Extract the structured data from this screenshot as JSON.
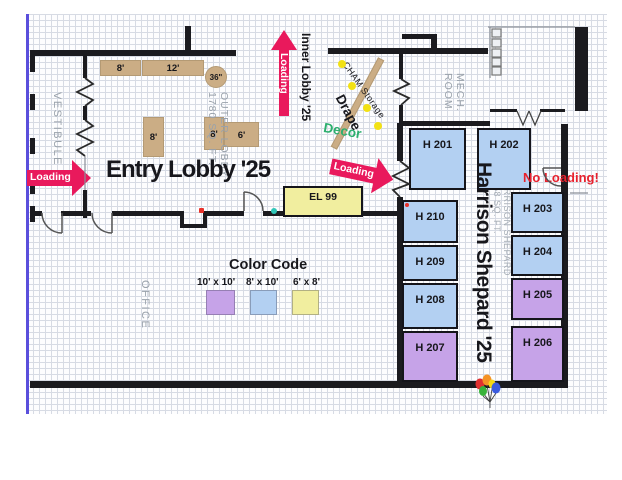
{
  "plan": {
    "entry_lobby_title": "Entry Lobby '25",
    "inner_lobby_title": "Inner Lobby '25",
    "harrison_title": "Harrison Shepard '25",
    "no_loading": "No Loading!",
    "loading": "Loading",
    "rooms": {
      "vestibule": "VESTIBULE",
      "outer_lobby": "OUTER LOBBY\n1780 SQ. FT.",
      "mech_room": "MECH.\nROOM",
      "office": "OFFICE",
      "harrison_corridor": "HARRISON SHEPARD\n1458 SQ. FT."
    },
    "annotations": {
      "cham_storage": "CHAM Storage",
      "drape": "Drape",
      "decor": "Decor"
    },
    "booths": [
      {
        "id": "H 201",
        "size": "8' x 10'"
      },
      {
        "id": "H 202",
        "size": "8' x 10'"
      },
      {
        "id": "H 203",
        "size": "8' x 10'"
      },
      {
        "id": "H 204",
        "size": "8' x 10'"
      },
      {
        "id": "H 205",
        "size": "10' x 10'"
      },
      {
        "id": "H 206",
        "size": "10' x 10'"
      },
      {
        "id": "H 207",
        "size": "10' x 10'"
      },
      {
        "id": "H 208",
        "size": "8' x 10'"
      },
      {
        "id": "H 209",
        "size": "8' x 10'"
      },
      {
        "id": "H 210",
        "size": "8' x 10'"
      },
      {
        "id": "EL 99",
        "size": "6' x 8'"
      }
    ],
    "furniture": {
      "shelf_a": "8'",
      "shelf_b": "12'",
      "round_table": "36\"",
      "table_a": "8'",
      "table_b": "8'",
      "table_c": "6'"
    },
    "legend": {
      "title": "Color Code",
      "items": [
        {
          "label": "10' x 10'",
          "color": "#c6a3e8"
        },
        {
          "label": "8' x 10'",
          "color": "#b3d0f2"
        },
        {
          "label": "6' x 8'",
          "color": "#f1ee9f"
        }
      ]
    },
    "colors": {
      "loading_arrow": "#e9195c",
      "no_loading_text": "#e8212d",
      "decor_text": "#2daf6e",
      "wall": "#1b1b1f",
      "grid_line": "#d7dbe4",
      "boundary_line": "#5a4fdc",
      "furniture": "#cbad85",
      "marker_dot": "#f2e114"
    }
  }
}
